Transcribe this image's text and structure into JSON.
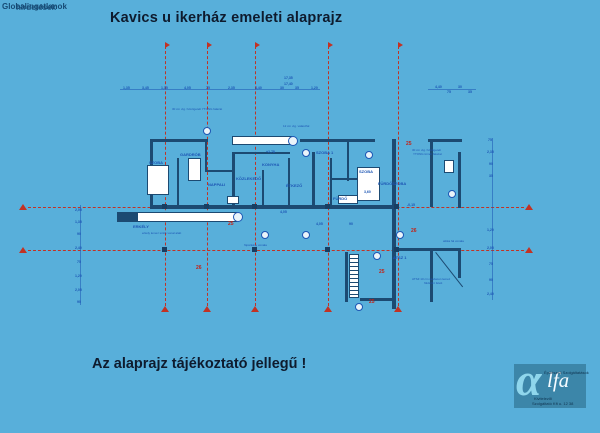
{
  "watermark": {
    "line1": "Globalingatlanok",
    "line2": "hirdetések"
  },
  "header": {
    "title": "Kavics u ikerház  emeleti alaprajz"
  },
  "footer": {
    "note": "Az alaprajz tájékoztató jellegű !"
  },
  "logo": {
    "alpha": "α",
    "name_rest": "lfa",
    "small_top": "Építészeti Szolgáltatások",
    "small_line1": "Kivitelezői",
    "small_line2": "Szolgáltató Kft u. 12 38"
  },
  "colors": {
    "background": "#58afda",
    "axis_red": "#c23224",
    "plan_blue": "#1d56b4",
    "wall_navy": "#1c4a72",
    "logo_bg": "#3c86a9"
  },
  "plan": {
    "axes_vertical": [
      {
        "x": 165,
        "y1": 46,
        "y2": 306
      },
      {
        "x": 207,
        "y1": 46,
        "y2": 306
      },
      {
        "x": 255,
        "y1": 46,
        "y2": 306
      },
      {
        "x": 328,
        "y1": 46,
        "y2": 306
      },
      {
        "x": 398,
        "y1": 46,
        "y2": 306
      }
    ],
    "axes_horizontal": [
      {
        "y": 207,
        "x1": 28,
        "x2": 524
      },
      {
        "y": 250,
        "x1": 28,
        "x2": 524
      }
    ],
    "red_labels": [
      {
        "text": "25",
        "x": 228,
        "y": 221
      },
      {
        "text": "25",
        "x": 406,
        "y": 141
      },
      {
        "text": "26",
        "x": 411,
        "y": 228
      },
      {
        "text": "26",
        "x": 196,
        "y": 265
      },
      {
        "text": "25",
        "x": 379,
        "y": 269
      },
      {
        "text": "25",
        "x": 369,
        "y": 299
      }
    ],
    "walls": [
      [
        150,
        139,
        58,
        3
      ],
      [
        300,
        139,
        75,
        3
      ],
      [
        428,
        139,
        34,
        3
      ],
      [
        150,
        139,
        3,
        69
      ],
      [
        177,
        158,
        2,
        48
      ],
      [
        205,
        139,
        2,
        32
      ],
      [
        232,
        152,
        3,
        56
      ],
      [
        262,
        170,
        2,
        38
      ],
      [
        288,
        158,
        2,
        50
      ],
      [
        235,
        152,
        55,
        2
      ],
      [
        312,
        152,
        3,
        56
      ],
      [
        330,
        158,
        2,
        49
      ],
      [
        347,
        139,
        2,
        42
      ],
      [
        392,
        139,
        4,
        170
      ],
      [
        430,
        139,
        3,
        68
      ],
      [
        458,
        152,
        3,
        56
      ],
      [
        330,
        178,
        30,
        2
      ],
      [
        205,
        170,
        28,
        2
      ],
      [
        150,
        205,
        162,
        4
      ],
      [
        312,
        205,
        84,
        4
      ],
      [
        396,
        248,
        64,
        3
      ],
      [
        430,
        248,
        3,
        54
      ],
      [
        458,
        248,
        3,
        30
      ],
      [
        360,
        298,
        36,
        3
      ],
      [
        345,
        252,
        3,
        50
      ]
    ],
    "white_boxes": [
      [
        147,
        165,
        22,
        30
      ],
      [
        188,
        158,
        13,
        23
      ],
      [
        357,
        167,
        23,
        34
      ],
      [
        444,
        160,
        10,
        13
      ],
      [
        338,
        195,
        20,
        9
      ],
      [
        227,
        196,
        12,
        8
      ]
    ],
    "balconies": [
      {
        "x": 117,
        "y": 212,
        "w": 120,
        "h": 10,
        "block": true,
        "circle": true
      },
      {
        "x": 232,
        "y": 136,
        "w": 60,
        "h": 9,
        "block": false,
        "circle": true
      }
    ],
    "stair": {
      "x": 349,
      "y": 254,
      "w": 10,
      "h": 44
    },
    "diag": {
      "x": 436,
      "y": 252,
      "len": 44,
      "deg": 52
    },
    "columns": [
      [
        162,
        204
      ],
      [
        204,
        204
      ],
      [
        252,
        204
      ],
      [
        325,
        204
      ],
      [
        394,
        204
      ],
      [
        162,
        247
      ],
      [
        252,
        247
      ],
      [
        325,
        247
      ],
      [
        394,
        247
      ]
    ],
    "circles": [
      [
        203,
        127
      ],
      [
        302,
        149
      ],
      [
        365,
        151
      ],
      [
        261,
        231
      ],
      [
        302,
        231
      ],
      [
        396,
        231
      ],
      [
        355,
        303
      ],
      [
        373,
        252
      ],
      [
        448,
        190
      ]
    ],
    "room_labels": [
      {
        "text": "SZOBA 1",
        "x": 316,
        "y": 150
      },
      {
        "text": "SZOBA",
        "x": 149,
        "y": 160
      },
      {
        "text": "SZOBA",
        "x": 359,
        "y": 169
      },
      {
        "text": "FÜRDŐSZOBA",
        "x": 378,
        "y": 181
      },
      {
        "text": "KONYHA",
        "x": 262,
        "y": 162
      },
      {
        "text": "NAPPALI",
        "x": 208,
        "y": 182
      },
      {
        "text": "ERKÉLY",
        "x": 133,
        "y": 224
      },
      {
        "text": "GARDRÓB",
        "x": 180,
        "y": 152
      },
      {
        "text": "ÉTKEZŐ",
        "x": 286,
        "y": 183
      },
      {
        "text": "KÖZLEKEDŐ",
        "x": 236,
        "y": 176
      },
      {
        "text": "FÜRDŐ",
        "x": 333,
        "y": 196
      },
      {
        "text": "ATSZ 1",
        "x": 393,
        "y": 255
      }
    ],
    "annotations": [
      {
        "text": "30 cm vtg. hőszigetelt YTONG falazat",
        "x": 172,
        "y": 107
      },
      {
        "text": "12 cm vtg. válaszfal",
        "x": 283,
        "y": 124
      },
      {
        "text": "30 cm vtg. hőszigetelt",
        "x": 412,
        "y": 148
      },
      {
        "text": "YTONG tömör falazat",
        "x": 413,
        "y": 152
      },
      {
        "text": "erkély lemez széle vonal alatt",
        "x": 142,
        "y": 231
      },
      {
        "text": "főpárkány vonala",
        "x": 244,
        "y": 243
      },
      {
        "text": "ATSZ 10 cm vasbeton lemez",
        "x": 412,
        "y": 277
      },
      {
        "text": "földszint felett",
        "x": 424,
        "y": 281
      },
      {
        "text": "attika fal vonala",
        "x": 443,
        "y": 239
      }
    ],
    "dims": [
      {
        "t": "1,35",
        "x": 123,
        "y": 86
      },
      {
        "t": "3,45",
        "x": 142,
        "y": 86
      },
      {
        "t": "1,35",
        "x": 161,
        "y": 86
      },
      {
        "t": "4,05",
        "x": 184,
        "y": 86
      },
      {
        "t": "75",
        "x": 206,
        "y": 86
      },
      {
        "t": "2,35",
        "x": 228,
        "y": 86
      },
      {
        "t": "4,40",
        "x": 255,
        "y": 86
      },
      {
        "t": "30",
        "x": 280,
        "y": 86
      },
      {
        "t": "35",
        "x": 295,
        "y": 86
      },
      {
        "t": "1,20",
        "x": 311,
        "y": 86
      },
      {
        "t": "17,35",
        "x": 284,
        "y": 76
      },
      {
        "t": "17,40",
        "x": 284,
        "y": 82
      },
      {
        "t": "4,40",
        "x": 435,
        "y": 85
      },
      {
        "t": "75",
        "x": 447,
        "y": 90
      },
      {
        "t": "30",
        "x": 458,
        "y": 85
      },
      {
        "t": "35",
        "x": 468,
        "y": 90
      },
      {
        "t": "2,05",
        "x": 75,
        "y": 208
      },
      {
        "t": "1,35",
        "x": 75,
        "y": 220
      },
      {
        "t": "90",
        "x": 77,
        "y": 232
      },
      {
        "t": "2,40",
        "x": 75,
        "y": 246
      },
      {
        "t": "75",
        "x": 77,
        "y": 260
      },
      {
        "t": "1,20",
        "x": 75,
        "y": 274
      },
      {
        "t": "2,05",
        "x": 75,
        "y": 288
      },
      {
        "t": "90",
        "x": 77,
        "y": 300
      },
      {
        "t": "75",
        "x": 488,
        "y": 138
      },
      {
        "t": "2,35",
        "x": 487,
        "y": 150
      },
      {
        "t": "90",
        "x": 489,
        "y": 162
      },
      {
        "t": "35",
        "x": 489,
        "y": 174
      },
      {
        "t": "1,20",
        "x": 487,
        "y": 228
      },
      {
        "t": "2,05",
        "x": 487,
        "y": 246
      },
      {
        "t": "75",
        "x": 489,
        "y": 262
      },
      {
        "t": "90",
        "x": 489,
        "y": 278
      },
      {
        "t": "2,40",
        "x": 487,
        "y": 292
      },
      {
        "t": "+2,78",
        "x": 266,
        "y": 150
      },
      {
        "t": "3,60",
        "x": 364,
        "y": 190
      },
      {
        "t": "4,05",
        "x": 316,
        "y": 222
      },
      {
        "t": "90",
        "x": 349,
        "y": 222
      },
      {
        "t": "-0,15",
        "x": 407,
        "y": 203
      },
      {
        "t": "4,05",
        "x": 280,
        "y": 210
      }
    ],
    "dimlines": [
      {
        "x": 120,
        "y": 89,
        "w": 200,
        "h": 1
      },
      {
        "x": 428,
        "y": 89,
        "w": 48,
        "h": 1
      },
      {
        "x": 80,
        "y": 205,
        "w": 1,
        "h": 100
      },
      {
        "x": 492,
        "y": 138,
        "w": 1,
        "h": 162
      }
    ]
  }
}
